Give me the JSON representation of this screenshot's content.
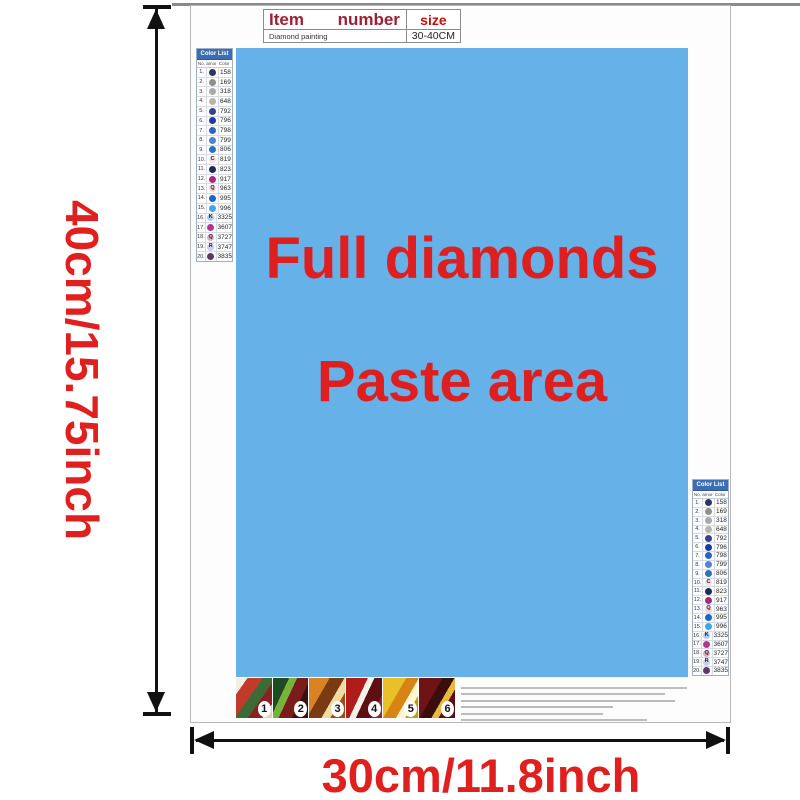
{
  "size_table": {
    "headers": [
      "Item",
      "number",
      "size"
    ],
    "row": [
      "Diamond painting",
      "",
      "30-40CM"
    ]
  },
  "paste_area": {
    "line1": "Full diamonds",
    "line2": "Paste area",
    "bg_color": "#66b1e7",
    "text_color": "#de1f1f"
  },
  "color_list": {
    "title": "Color List",
    "columns": [
      "No.",
      "Diamond",
      "Color"
    ],
    "header_bg": "#3a6db4",
    "rows": [
      {
        "no": "1.",
        "symbol": "",
        "circle": "#2e3366",
        "dark": true,
        "code": "158"
      },
      {
        "no": "2.",
        "symbol": "",
        "circle": "#8f8f8f",
        "dark": true,
        "code": "169"
      },
      {
        "no": "3.",
        "symbol": "",
        "circle": "#a9a9a9",
        "dark": true,
        "code": "318"
      },
      {
        "no": "4.",
        "symbol": "",
        "circle": "#b6b6ac",
        "dark": true,
        "code": "648"
      },
      {
        "no": "5.",
        "symbol": "",
        "circle": "#39418f",
        "dark": true,
        "code": "792"
      },
      {
        "no": "6.",
        "symbol": "",
        "circle": "#1f3a9e",
        "dark": true,
        "code": "796"
      },
      {
        "no": "7.",
        "symbol": "",
        "circle": "#2f62c0",
        "dark": true,
        "code": "798"
      },
      {
        "no": "8.",
        "symbol": "",
        "circle": "#4f82d2",
        "dark": true,
        "code": "799"
      },
      {
        "no": "9.",
        "symbol": "",
        "circle": "#2d72b8",
        "dark": true,
        "code": "806"
      },
      {
        "no": "10.",
        "symbol": "C",
        "circle": "#f8ddd8",
        "dark": false,
        "code": "819"
      },
      {
        "no": "11.",
        "symbol": "",
        "circle": "#1c2b57",
        "dark": true,
        "code": "823"
      },
      {
        "no": "12.",
        "symbol": "",
        "circle": "#a62a80",
        "dark": true,
        "code": "917"
      },
      {
        "no": "13.",
        "symbol": "Q",
        "circle": "#f6d2cc",
        "dark": false,
        "code": "963"
      },
      {
        "no": "14.",
        "symbol": "",
        "circle": "#1668c8",
        "dark": true,
        "code": "995"
      },
      {
        "no": "15.",
        "symbol": "",
        "circle": "#41a5e1",
        "dark": true,
        "code": "996"
      },
      {
        "no": "16.",
        "symbol": "K",
        "circle": "#aecbe9",
        "dark": false,
        "code": "3325"
      },
      {
        "no": "17.",
        "symbol": "",
        "circle": "#b13790",
        "dark": true,
        "code": "3607"
      },
      {
        "no": "18.",
        "symbol": "Q",
        "circle": "#dcadbc",
        "dark": false,
        "code": "3727"
      },
      {
        "no": "19.",
        "symbol": "R",
        "circle": "#cdd0ea",
        "dark": false,
        "code": "3747"
      },
      {
        "no": "20.",
        "symbol": "",
        "circle": "#5d3a66",
        "dark": true,
        "code": "3835"
      }
    ]
  },
  "steps": {
    "labels": [
      "1",
      "2",
      "3",
      "4",
      "5",
      "6"
    ]
  },
  "dimensions": {
    "height_label": "40cm/15.75inch",
    "width_label": "30cm/11.8inch",
    "color": "#e01f1f"
  }
}
